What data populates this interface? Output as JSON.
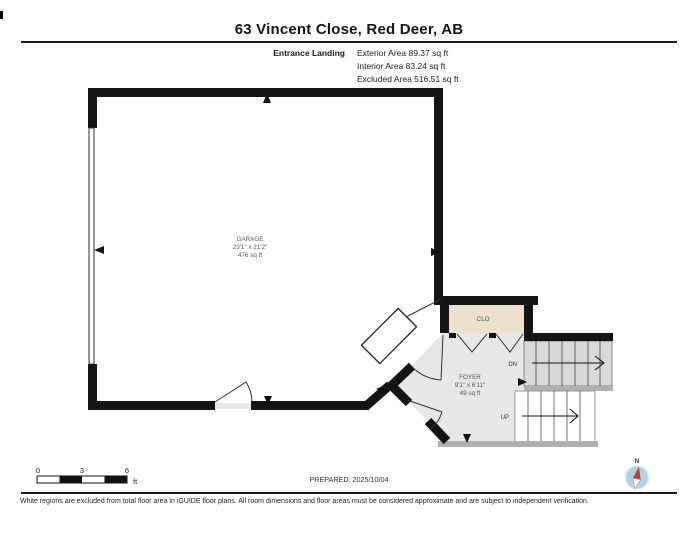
{
  "header": {
    "title": "63 Vincent Close, Red Deer, AB",
    "floor_label": "Entrance Landing",
    "areas": {
      "exterior": "Exterior Area 89.37 sq ft",
      "interior": "Interior Area 83.24 sq ft",
      "excluded": "Excluded Area 516.51 sq ft"
    }
  },
  "plan": {
    "garage": {
      "name": "GARAGE",
      "dimensions": "23'1\" x 21'2\"",
      "area": "476 sq ft"
    },
    "foyer": {
      "name": "FOYER",
      "dimensions": "9'1\" x 6'11\"",
      "area": "49 sq ft"
    },
    "closet": {
      "name": "CLO"
    },
    "stairs": {
      "down_label": "DN",
      "up_label": "UP"
    }
  },
  "scale_bar": {
    "tick_0": "0",
    "tick_3": "3",
    "tick_6": "6",
    "unit": "ft"
  },
  "compass": {
    "north_label": "N"
  },
  "footer": {
    "prepared": "PREPARED: 2025/10/04",
    "disclaimer": "White regions are excluded from total floor area in iGUIDE floor plans. All room dimensions and floor areas must be considered approximate and are subject to independent verification."
  },
  "colors": {
    "wall": "#141414",
    "interior_floor": "#e7e7e7",
    "closet_floor": "#ecdfcc",
    "stair_down_fill": "#d9d9d9",
    "stair_up_fill": "#ffffff",
    "wall_shadow": "#b0b0b0",
    "compass_blue": "#aed3e7",
    "compass_red": "#c23b2e"
  }
}
